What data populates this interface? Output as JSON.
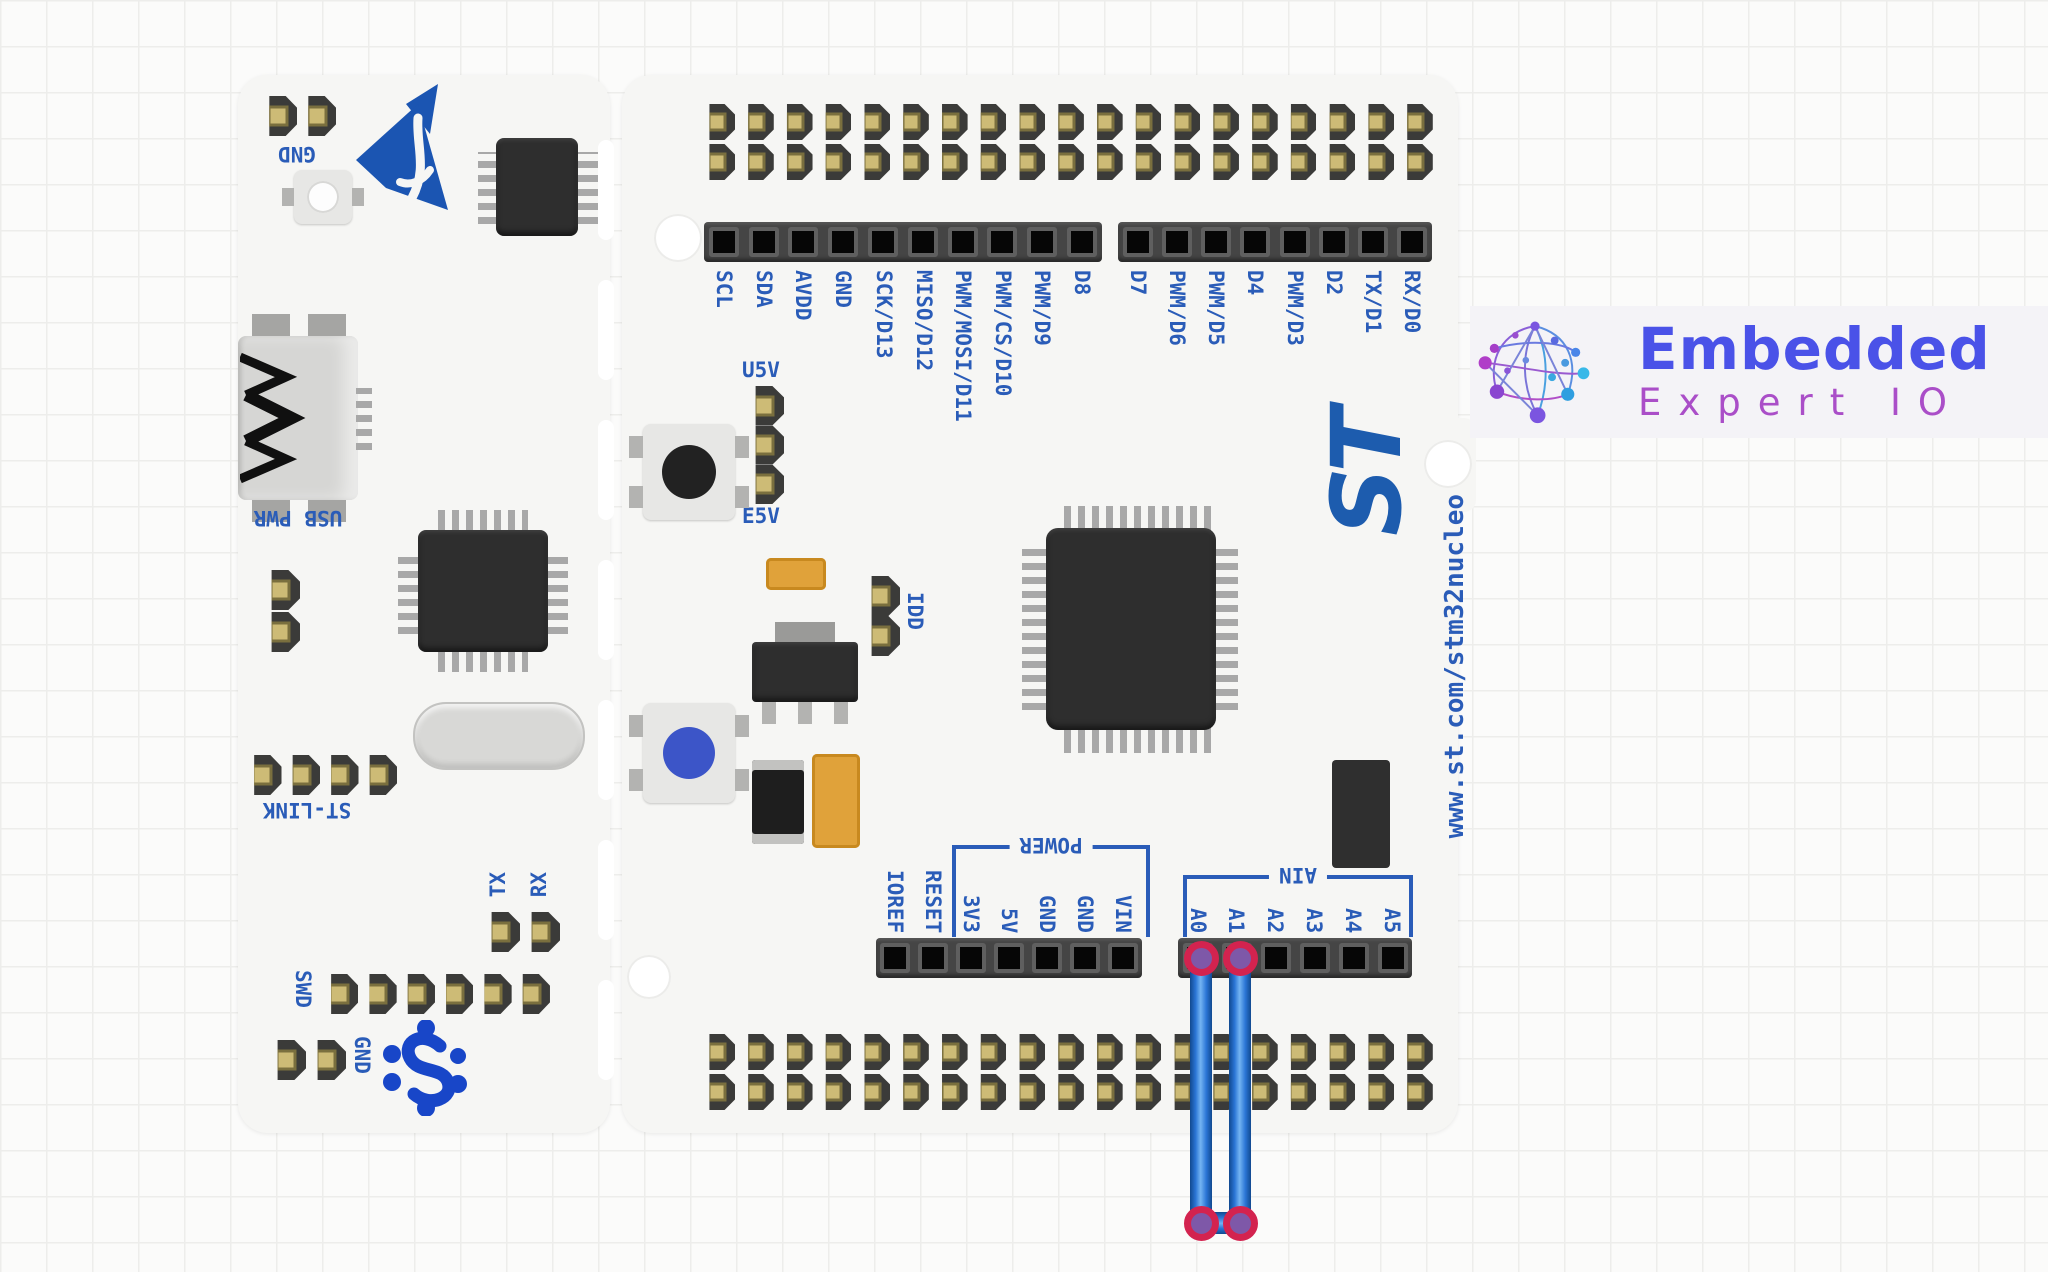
{
  "branding": {
    "title": "Embedded",
    "subtitle": "Expert IO",
    "title_color": "#4a52e8",
    "subtitle_color": "#aa4ec8"
  },
  "board": {
    "name": "ST Nucleo-64",
    "url": "www.st.com/stm32nucleo",
    "st_logo_text": "ST",
    "silkscreen_color": "#2a5cb8",
    "left_section": {
      "gnd_top_label": "GND",
      "usb_label": "USB PWR",
      "stlink_label": "ST-LINK",
      "tx_label": "TX",
      "rx_label": "RX",
      "swd_label": "SWD",
      "gnd_bottom_label": "GND",
      "pin_counts": {
        "gnd_top": 2,
        "stlink": 4,
        "txrx": 2,
        "swd": 6,
        "gnd_bottom": 2,
        "aux": 2
      }
    },
    "jumpers": {
      "u5v_label": "U5V",
      "e5v_label": "E5V",
      "idd_label": "IDD",
      "power_select_pins": 3,
      "idd_pins": 2
    },
    "morpho_cols": 19,
    "io_left": {
      "holes": 10,
      "labels": [
        "SCL",
        "SDA",
        "AVDD",
        "GND",
        "SCK/D13",
        "MISO/D12",
        "PWM/MOSI/D11",
        "PWM/CS/D10",
        "PWM/D9",
        "D8"
      ]
    },
    "io_right": {
      "holes": 8,
      "labels": [
        "D7",
        "PWM/D6",
        "PWM/D5",
        "D4",
        "PWM/D3",
        "D2",
        "TX/D1",
        "RX/D0"
      ]
    },
    "power_header": {
      "holes": 7,
      "group_label": "POWER",
      "labels": [
        "IOREF",
        "RESET",
        "3V3",
        "5V",
        "GND",
        "GND",
        "VIN"
      ]
    },
    "analog_header": {
      "holes": 6,
      "group_label": "AIN",
      "labels": [
        "A0",
        "A1",
        "A2",
        "A3",
        "A4",
        "A5"
      ]
    }
  },
  "wire": {
    "color": "#1e6ad0",
    "from": "A0",
    "to": "A1"
  }
}
